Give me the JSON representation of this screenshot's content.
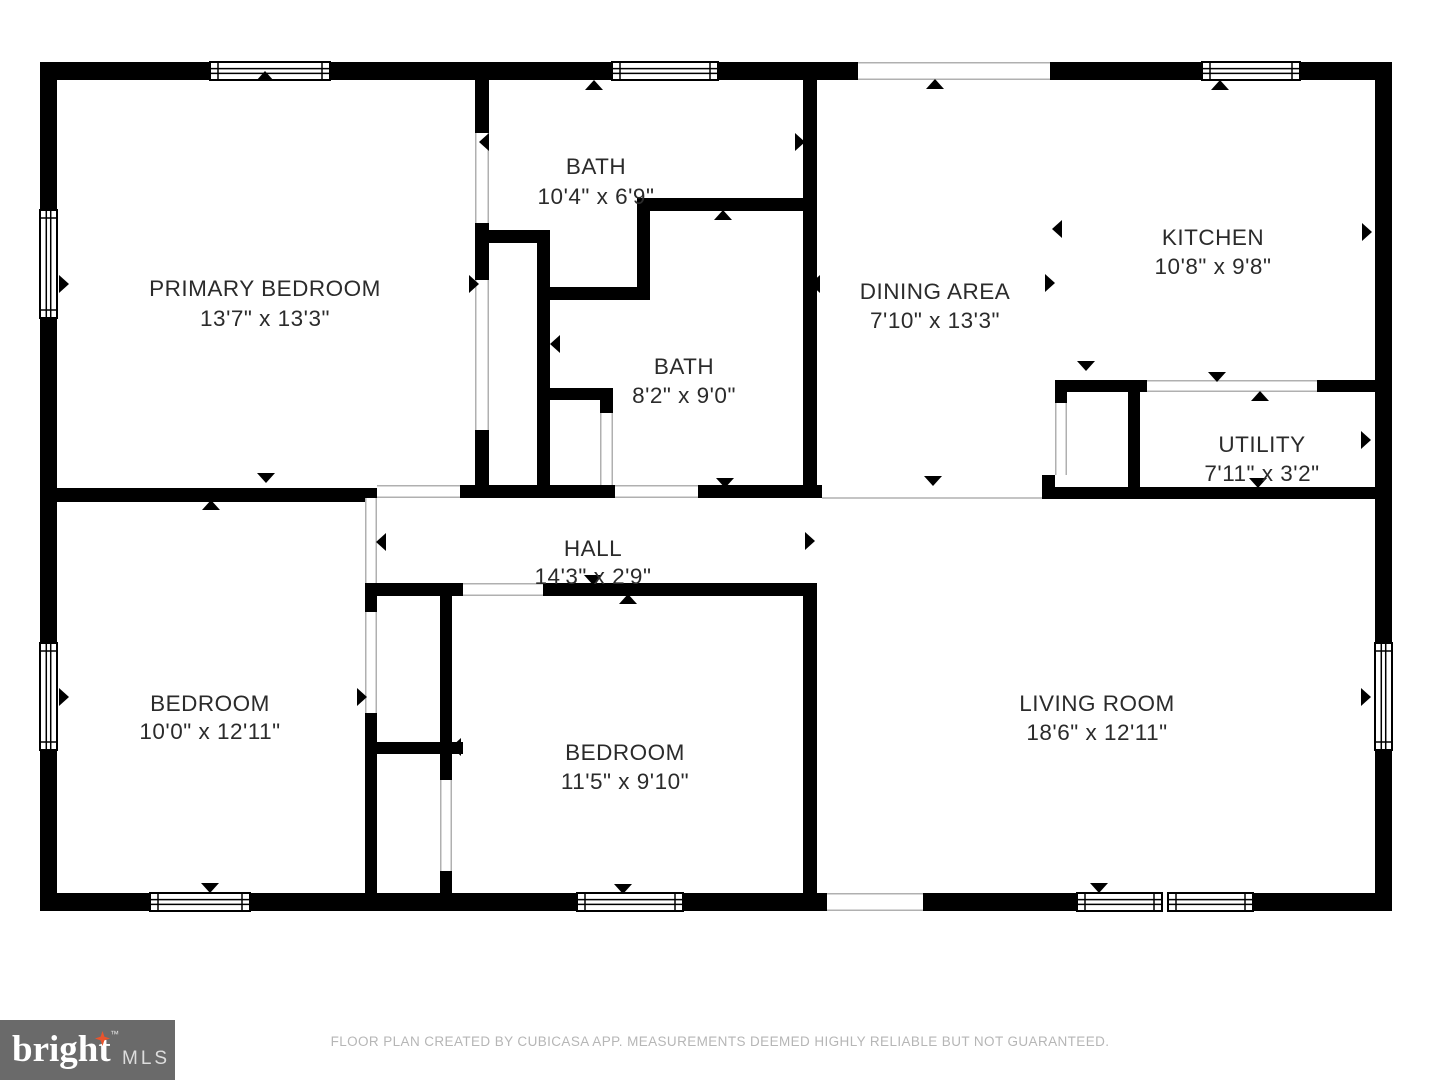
{
  "floorplan": {
    "wall_color": "#000000",
    "label_color": "#2b2b2b",
    "opening_line_color": "#b0b0b0",
    "rooms": [
      {
        "id": "primary-bedroom",
        "name": "PRIMARY BEDROOM",
        "dims": "13'7\" x 13'3\""
      },
      {
        "id": "bath-1",
        "name": "BATH",
        "dims": "10'4\" x 6'9\""
      },
      {
        "id": "dining-area",
        "name": "DINING AREA",
        "dims": "7'10\" x 13'3\""
      },
      {
        "id": "kitchen",
        "name": "KITCHEN",
        "dims": "10'8\" x 9'8\""
      },
      {
        "id": "bath-2",
        "name": "BATH",
        "dims": "8'2\" x 9'0\""
      },
      {
        "id": "utility",
        "name": "UTILITY",
        "dims": "7'11\" x 3'2\""
      },
      {
        "id": "hall",
        "name": "HALL",
        "dims": "14'3\" x 2'9\""
      },
      {
        "id": "bedroom-left",
        "name": "BEDROOM",
        "dims": "10'0\" x 12'11\""
      },
      {
        "id": "bedroom-middle",
        "name": "BEDROOM",
        "dims": "11'5\" x 9'10\""
      },
      {
        "id": "living-room",
        "name": "LIVING ROOM",
        "dims": "18'6\" x 12'11\""
      }
    ]
  },
  "logo": {
    "brand": "bright",
    "suffix": "MLS",
    "trademark": "™",
    "bg_color": "#6a6a6a",
    "star_color": "#e8542d"
  },
  "footer": {
    "disclaimer": "FLOOR PLAN CREATED BY CUBICASA APP. MEASUREMENTS DEEMED HIGHLY RELIABLE BUT NOT GUARANTEED."
  }
}
